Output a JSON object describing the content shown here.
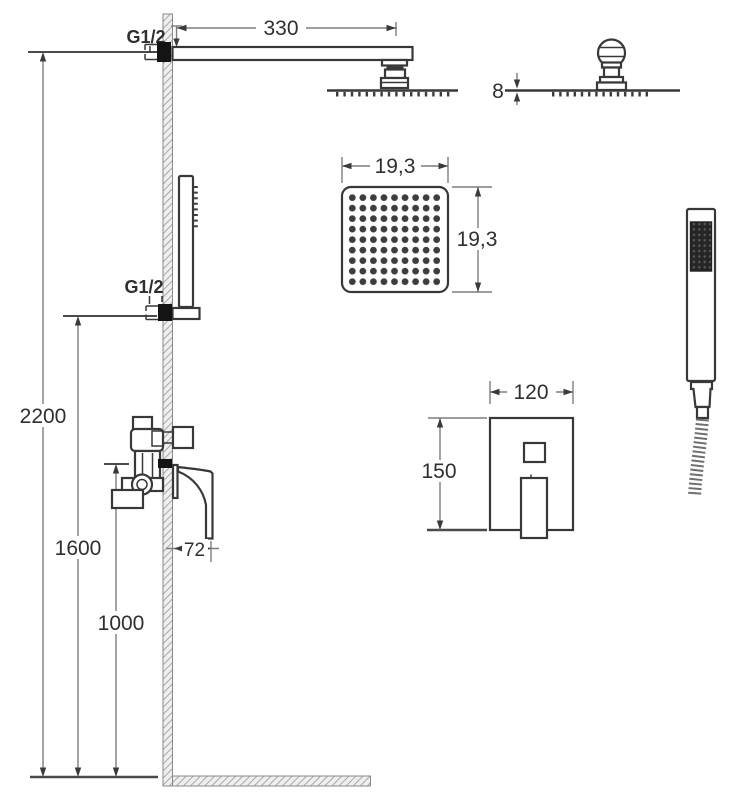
{
  "drawing": {
    "kind": "shower-set dimensional technical drawing",
    "labels": {
      "thread_top": "G1/2",
      "thread_handshower": "G1/2",
      "arm_length": "330",
      "head_thickness": "8",
      "head_width": "19,3",
      "head_depth": "19,3",
      "height_total": "2200",
      "height_handshower": "1600",
      "height_mixer": "1000",
      "mixer_offset": "72",
      "plate_width": "120",
      "plate_height": "150"
    },
    "colors": {
      "line": "#383838",
      "dim_line": "#7d7d7d",
      "hatch": "#9b9b9b",
      "background": "#ffffff"
    }
  }
}
